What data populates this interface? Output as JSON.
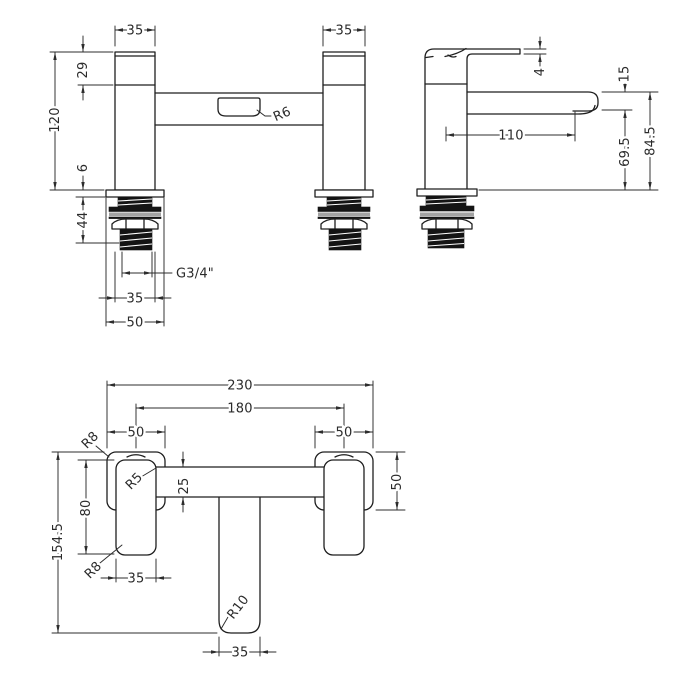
{
  "title": "Bath filler tap technical drawing",
  "colors": {
    "background": "#ffffff",
    "line": "#1f1f1f",
    "dim_line": "#2c2c2c",
    "thread_fill": "#141414",
    "washer_gray": "#a3a3a3"
  },
  "front": {
    "dims": {
      "left_body_width": "35",
      "right_body_width": "35",
      "cap_height": "29",
      "overall_height": "120",
      "deck_thickness": "6",
      "shank_length": "44",
      "thread_spec": "G3/4\"",
      "shank_width": "35",
      "base_width": "50",
      "slot_radius": "R6"
    }
  },
  "side": {
    "dims": {
      "lever_thickness": "4",
      "spout_end_height": "15",
      "spout_reach": "110",
      "height_under_spout": "69.5",
      "overall_height": "84.5"
    }
  },
  "plan": {
    "dims": {
      "overall_width": "230",
      "hole_centres": "180",
      "left_base_width": "50",
      "right_base_width": "50",
      "bar_depth": "25",
      "lever_length": "80",
      "overall_depth": "154.5",
      "lever_width": "35",
      "spout_width": "35",
      "base_depth": "50",
      "base_corner_radius": "R8",
      "bar_fillet_radius": "R5",
      "lever_corner_radius": "R8",
      "spout_corner_radius": "R10"
    }
  }
}
